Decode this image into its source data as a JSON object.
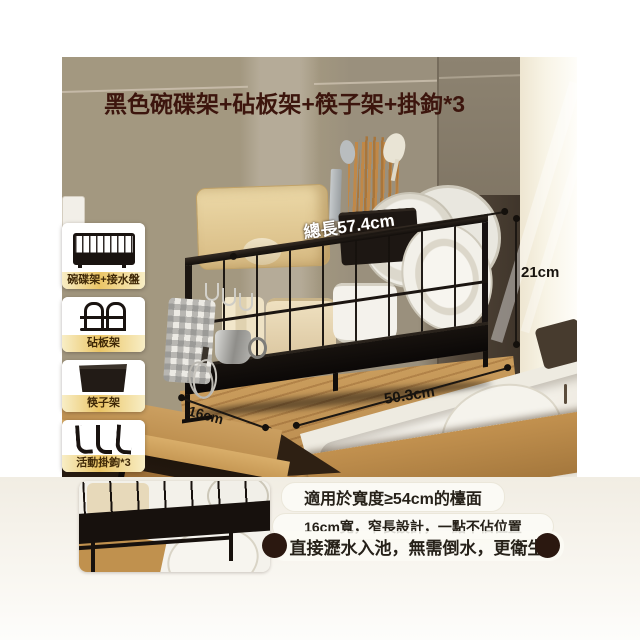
{
  "title": {
    "text": "黑色碗碟架+砧板架+筷子架+掛鉤*3",
    "color": "#3c150d"
  },
  "sidebar": {
    "items": [
      {
        "label": "碗碟架+接水盤",
        "icon": "wire-basket-icon"
      },
      {
        "label": "砧板架",
        "icon": "cutting-board-stand-icon"
      },
      {
        "label": "筷子架",
        "icon": "chopstick-holder-icon"
      },
      {
        "label": "活動掛鉤*3",
        "icon": "triple-hooks-icon"
      }
    ]
  },
  "photo": {
    "dimensions": {
      "total_length": "總長57.4cm",
      "height": "21cm",
      "length": "50.3cm",
      "depth": "16cm"
    }
  },
  "features": {
    "line1": "適用於寬度≥54cm的檯面",
    "line2": "16cm寬，窄長設計，一點不佔位置",
    "line3": "直接瀝水入池，無需倒水，更衛生"
  },
  "colors": {
    "title_text": "#3c150d",
    "label_highlight": "#ebc566",
    "label_text": "#3f2807",
    "rack_black": "#1b1511",
    "wood_counter": "#c59755",
    "tile_wall": "#a39880",
    "feature_dot": "#2b1810",
    "pill_bg": "#fbfaf5",
    "dimension_text_dark": "#17130e",
    "dimension_text_light": "#ffffff"
  }
}
